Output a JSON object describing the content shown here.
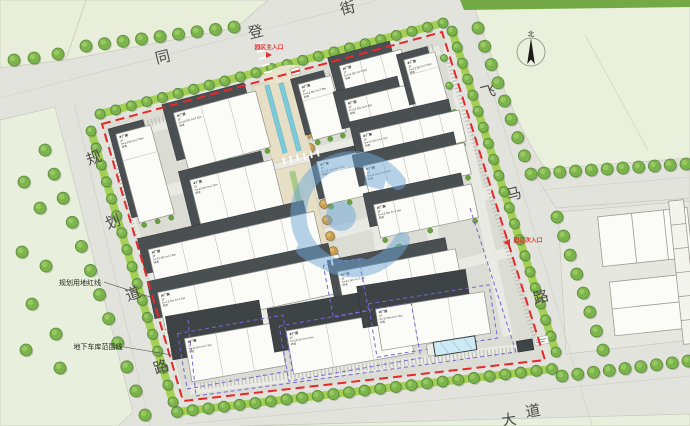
{
  "streets": {
    "top": [
      "同",
      "登",
      "街"
    ],
    "left": [
      "规",
      "划",
      "道",
      "路"
    ],
    "right": [
      "飞",
      "马",
      "路"
    ],
    "bottom": [
      "大",
      "道"
    ]
  },
  "labels": {
    "main_entrance": "园区主入口",
    "secondary_entrance": "园区次入口",
    "red_line_callout": "规划用地红线",
    "garage_callout": "地下车库范围线",
    "north": "北"
  },
  "building_label": {
    "title": "#厂房",
    "floors": "2F",
    "heights": "h=12.0m h=7.0m",
    "tag": "研发"
  },
  "colors": {
    "boundary_red": "#e7282b",
    "garage_purple": "#7b63d2",
    "water_teal": "#7cc9da",
    "hedge_green": "#9fce48",
    "tree_green": "#7cb44c",
    "tree_dark": "#57893a",
    "tan_tree": "#c89d52",
    "watermark_blue": "#6fa8d8",
    "entrance_red": "#e23030",
    "road": "#e2e3dc",
    "lawn": "#e8eedb",
    "site": "#dbddd5"
  }
}
